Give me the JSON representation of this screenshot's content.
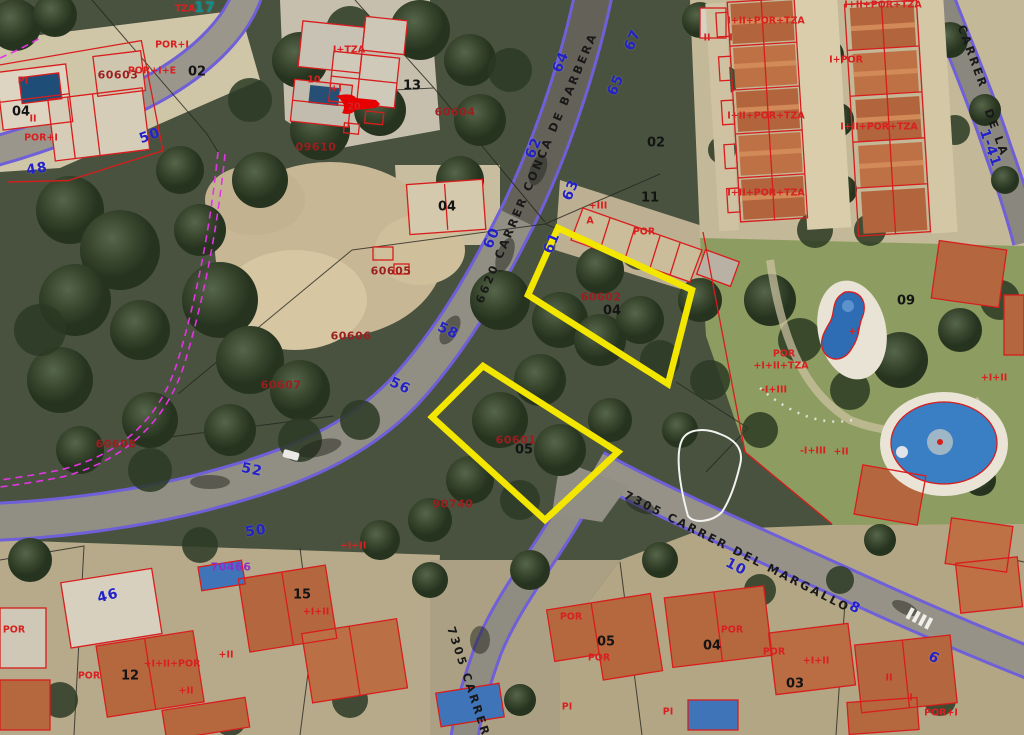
{
  "map": {
    "type": "cadastral-aerial-viewer",
    "colors": {
      "highlight": "#f3e600",
      "cadastral": "#d81d1d",
      "road_edge": "#6f5fd8",
      "boundary_dashed": "#e335e3",
      "house_number": "#2222c8",
      "parcel_ref": "#9b1f1f"
    },
    "highlighted_parcels": [
      {
        "ref": "60602",
        "number": "04"
      },
      {
        "ref": "60601",
        "number": "05"
      }
    ],
    "label_groups": [
      {
        "cls": "street-label",
        "name": "street-name-label",
        "items": [
          {
            "t": "6620 CARRER CONCA DE BARBERA",
            "x": 537,
            "y": 168,
            "r": -67
          },
          {
            "t": "7305 CARRER DEL MARGALLO",
            "x": 737,
            "y": 552,
            "r": 27
          },
          {
            "t": "7305 CARRER",
            "x": 468,
            "y": 682,
            "r": 72
          },
          {
            "t": "CARRER",
            "x": 972,
            "y": 57,
            "r": 70
          },
          {
            "t": "DE LA",
            "x": 996,
            "y": 133,
            "r": 70
          }
        ]
      },
      {
        "cls": "house-number",
        "name": "house-number-label",
        "items": [
          {
            "t": "64",
            "x": 561,
            "y": 62,
            "r": -67
          },
          {
            "t": "62",
            "x": 534,
            "y": 148,
            "r": -67
          },
          {
            "t": "60",
            "x": 492,
            "y": 238,
            "r": -67
          },
          {
            "t": "58",
            "x": 448,
            "y": 331,
            "r": 25
          },
          {
            "t": "56",
            "x": 400,
            "y": 386,
            "r": 25
          },
          {
            "t": "52",
            "x": 252,
            "y": 470,
            "r": 12
          },
          {
            "t": "50",
            "x": 150,
            "y": 136,
            "r": -20
          },
          {
            "t": "48",
            "x": 37,
            "y": 169,
            "r": -10
          },
          {
            "t": "67",
            "x": 633,
            "y": 40,
            "r": -67
          },
          {
            "t": "65",
            "x": 616,
            "y": 85,
            "r": -67
          },
          {
            "t": "63",
            "x": 571,
            "y": 190,
            "r": -67
          },
          {
            "t": "61",
            "x": 552,
            "y": 243,
            "r": -67
          },
          {
            "t": "10",
            "x": 736,
            "y": 567,
            "r": 27
          },
          {
            "t": "8",
            "x": 855,
            "y": 608,
            "r": 27
          },
          {
            "t": "6",
            "x": 934,
            "y": 658,
            "r": 27
          },
          {
            "t": "46",
            "x": 108,
            "y": 596,
            "r": -15
          },
          {
            "t": "50",
            "x": 256,
            "y": 531,
            "r": -8
          },
          {
            "t": "1-41",
            "x": 990,
            "y": 148,
            "r": 70
          },
          {
            "t": "17",
            "x": 205,
            "y": 8,
            "r": 0,
            "c": "#0a8f8f"
          }
        ]
      },
      {
        "cls": "parcel-number",
        "name": "parcel-number-label",
        "items": [
          {
            "t": "02",
            "x": 197,
            "y": 72,
            "r": 0
          },
          {
            "t": "04",
            "x": 21,
            "y": 112,
            "r": 0
          },
          {
            "t": "13",
            "x": 412,
            "y": 86,
            "r": 0
          },
          {
            "t": "11",
            "x": 650,
            "y": 198,
            "r": 0
          },
          {
            "t": "02",
            "x": 656,
            "y": 143,
            "r": 0
          },
          {
            "t": "04",
            "x": 447,
            "y": 207,
            "r": 0
          },
          {
            "t": "04",
            "x": 612,
            "y": 311,
            "r": 0
          },
          {
            "t": "05",
            "x": 524,
            "y": 450,
            "r": 0
          },
          {
            "t": "09",
            "x": 906,
            "y": 301,
            "r": 0
          },
          {
            "t": "05",
            "x": 606,
            "y": 642,
            "r": 0
          },
          {
            "t": "04",
            "x": 712,
            "y": 646,
            "r": 0
          },
          {
            "t": "03",
            "x": 795,
            "y": 684,
            "r": 0
          },
          {
            "t": "12",
            "x": 130,
            "y": 676,
            "r": 0
          },
          {
            "t": "15",
            "x": 302,
            "y": 595,
            "r": 0
          }
        ]
      },
      {
        "cls": "parcel-ref",
        "name": "parcel-ref-label",
        "items": [
          {
            "t": "60603",
            "x": 118,
            "y": 75,
            "r": 0
          },
          {
            "t": "60604",
            "x": 455,
            "y": 112,
            "r": 0
          },
          {
            "t": "09610",
            "x": 316,
            "y": 147,
            "r": 0
          },
          {
            "t": "60605",
            "x": 391,
            "y": 271,
            "r": 0
          },
          {
            "t": "60606",
            "x": 351,
            "y": 336,
            "r": 0
          },
          {
            "t": "60607",
            "x": 281,
            "y": 385,
            "r": 0
          },
          {
            "t": "60608",
            "x": 116,
            "y": 444,
            "r": 0
          },
          {
            "t": "60602",
            "x": 601,
            "y": 297,
            "r": 0
          },
          {
            "t": "60601",
            "x": 516,
            "y": 440,
            "r": 0
          },
          {
            "t": "90740",
            "x": 453,
            "y": 504,
            "r": 0
          },
          {
            "t": "70466",
            "x": 231,
            "y": 567,
            "r": 0,
            "c": "#8b30c8"
          }
        ]
      },
      {
        "cls": "construction-code",
        "name": "construction-code-label",
        "items": [
          {
            "t": "TZA",
            "x": 185,
            "y": 9,
            "r": 0
          },
          {
            "t": "POR+I",
            "x": 172,
            "y": 45,
            "r": 0
          },
          {
            "t": "POR+I+E",
            "x": 152,
            "y": 71,
            "r": 0
          },
          {
            "t": "10",
            "x": 314,
            "y": 80,
            "r": 0
          },
          {
            "t": "PI",
            "x": 23,
            "y": 81,
            "r": 0
          },
          {
            "t": "II",
            "x": 33,
            "y": 119,
            "r": 0
          },
          {
            "t": "POR+I",
            "x": 41,
            "y": 138,
            "r": 0
          },
          {
            "t": "I+TZA",
            "x": 349,
            "y": 50,
            "r": 0
          },
          {
            "t": "+I",
            "x": 336,
            "y": 89,
            "r": 0
          },
          {
            "t": "20",
            "x": 354,
            "y": 107,
            "r": 0
          },
          {
            "t": "+III",
            "x": 598,
            "y": 206,
            "r": 0
          },
          {
            "t": "A",
            "x": 590,
            "y": 221,
            "r": 0
          },
          {
            "t": "POR",
            "x": 644,
            "y": 232,
            "r": 0
          },
          {
            "t": "II",
            "x": 707,
            "y": 38,
            "r": 0
          },
          {
            "t": "I",
            "x": 731,
            "y": 38,
            "r": 0
          },
          {
            "t": "I+II+POR+TZA",
            "x": 766,
            "y": 21,
            "r": 0
          },
          {
            "t": "I+II+POR+TZA",
            "x": 766,
            "y": 116,
            "r": 0
          },
          {
            "t": "I+II+POR+TZA",
            "x": 766,
            "y": 193,
            "r": 0
          },
          {
            "t": "I+II+POR+TZA",
            "x": 883,
            "y": 5,
            "r": 0
          },
          {
            "t": "I+II+POR+TZA",
            "x": 879,
            "y": 127,
            "r": 0
          },
          {
            "t": "I+POR",
            "x": 846,
            "y": 60,
            "r": 0
          },
          {
            "t": "POR",
            "x": 784,
            "y": 354,
            "r": 0
          },
          {
            "t": "+I+II+TZA",
            "x": 781,
            "y": 366,
            "r": 0
          },
          {
            "t": "+I",
            "x": 854,
            "y": 332,
            "r": 0
          },
          {
            "t": "-I+III",
            "x": 774,
            "y": 390,
            "r": 0
          },
          {
            "t": "-I+III",
            "x": 813,
            "y": 451,
            "r": 0
          },
          {
            "t": "+II",
            "x": 841,
            "y": 452,
            "r": 0
          },
          {
            "t": "+I+II",
            "x": 994,
            "y": 378,
            "r": 0
          },
          {
            "t": "POR",
            "x": 571,
            "y": 617,
            "r": 0
          },
          {
            "t": "POR",
            "x": 599,
            "y": 658,
            "r": 0
          },
          {
            "t": "POR",
            "x": 732,
            "y": 630,
            "r": 0
          },
          {
            "t": "POR",
            "x": 774,
            "y": 652,
            "r": 0
          },
          {
            "t": "+I+II",
            "x": 816,
            "y": 661,
            "r": 0
          },
          {
            "t": "PI",
            "x": 567,
            "y": 707,
            "r": 0
          },
          {
            "t": "PI",
            "x": 668,
            "y": 712,
            "r": 0
          },
          {
            "t": "POR",
            "x": 89,
            "y": 676,
            "r": 0
          },
          {
            "t": "+II",
            "x": 186,
            "y": 691,
            "r": 0
          },
          {
            "t": "+I+II+POR",
            "x": 172,
            "y": 664,
            "r": 0
          },
          {
            "t": "+I+II",
            "x": 316,
            "y": 612,
            "r": 0
          },
          {
            "t": "+II",
            "x": 226,
            "y": 655,
            "r": 0
          },
          {
            "t": "+I+II",
            "x": 353,
            "y": 546,
            "r": 0
          },
          {
            "t": "POR",
            "x": 14,
            "y": 630,
            "r": 0
          },
          {
            "t": "II",
            "x": 889,
            "y": 678,
            "r": 0
          },
          {
            "t": "I",
            "x": 911,
            "y": 698,
            "r": 0
          },
          {
            "t": "POR+I",
            "x": 941,
            "y": 713,
            "r": 0
          }
        ]
      }
    ]
  }
}
